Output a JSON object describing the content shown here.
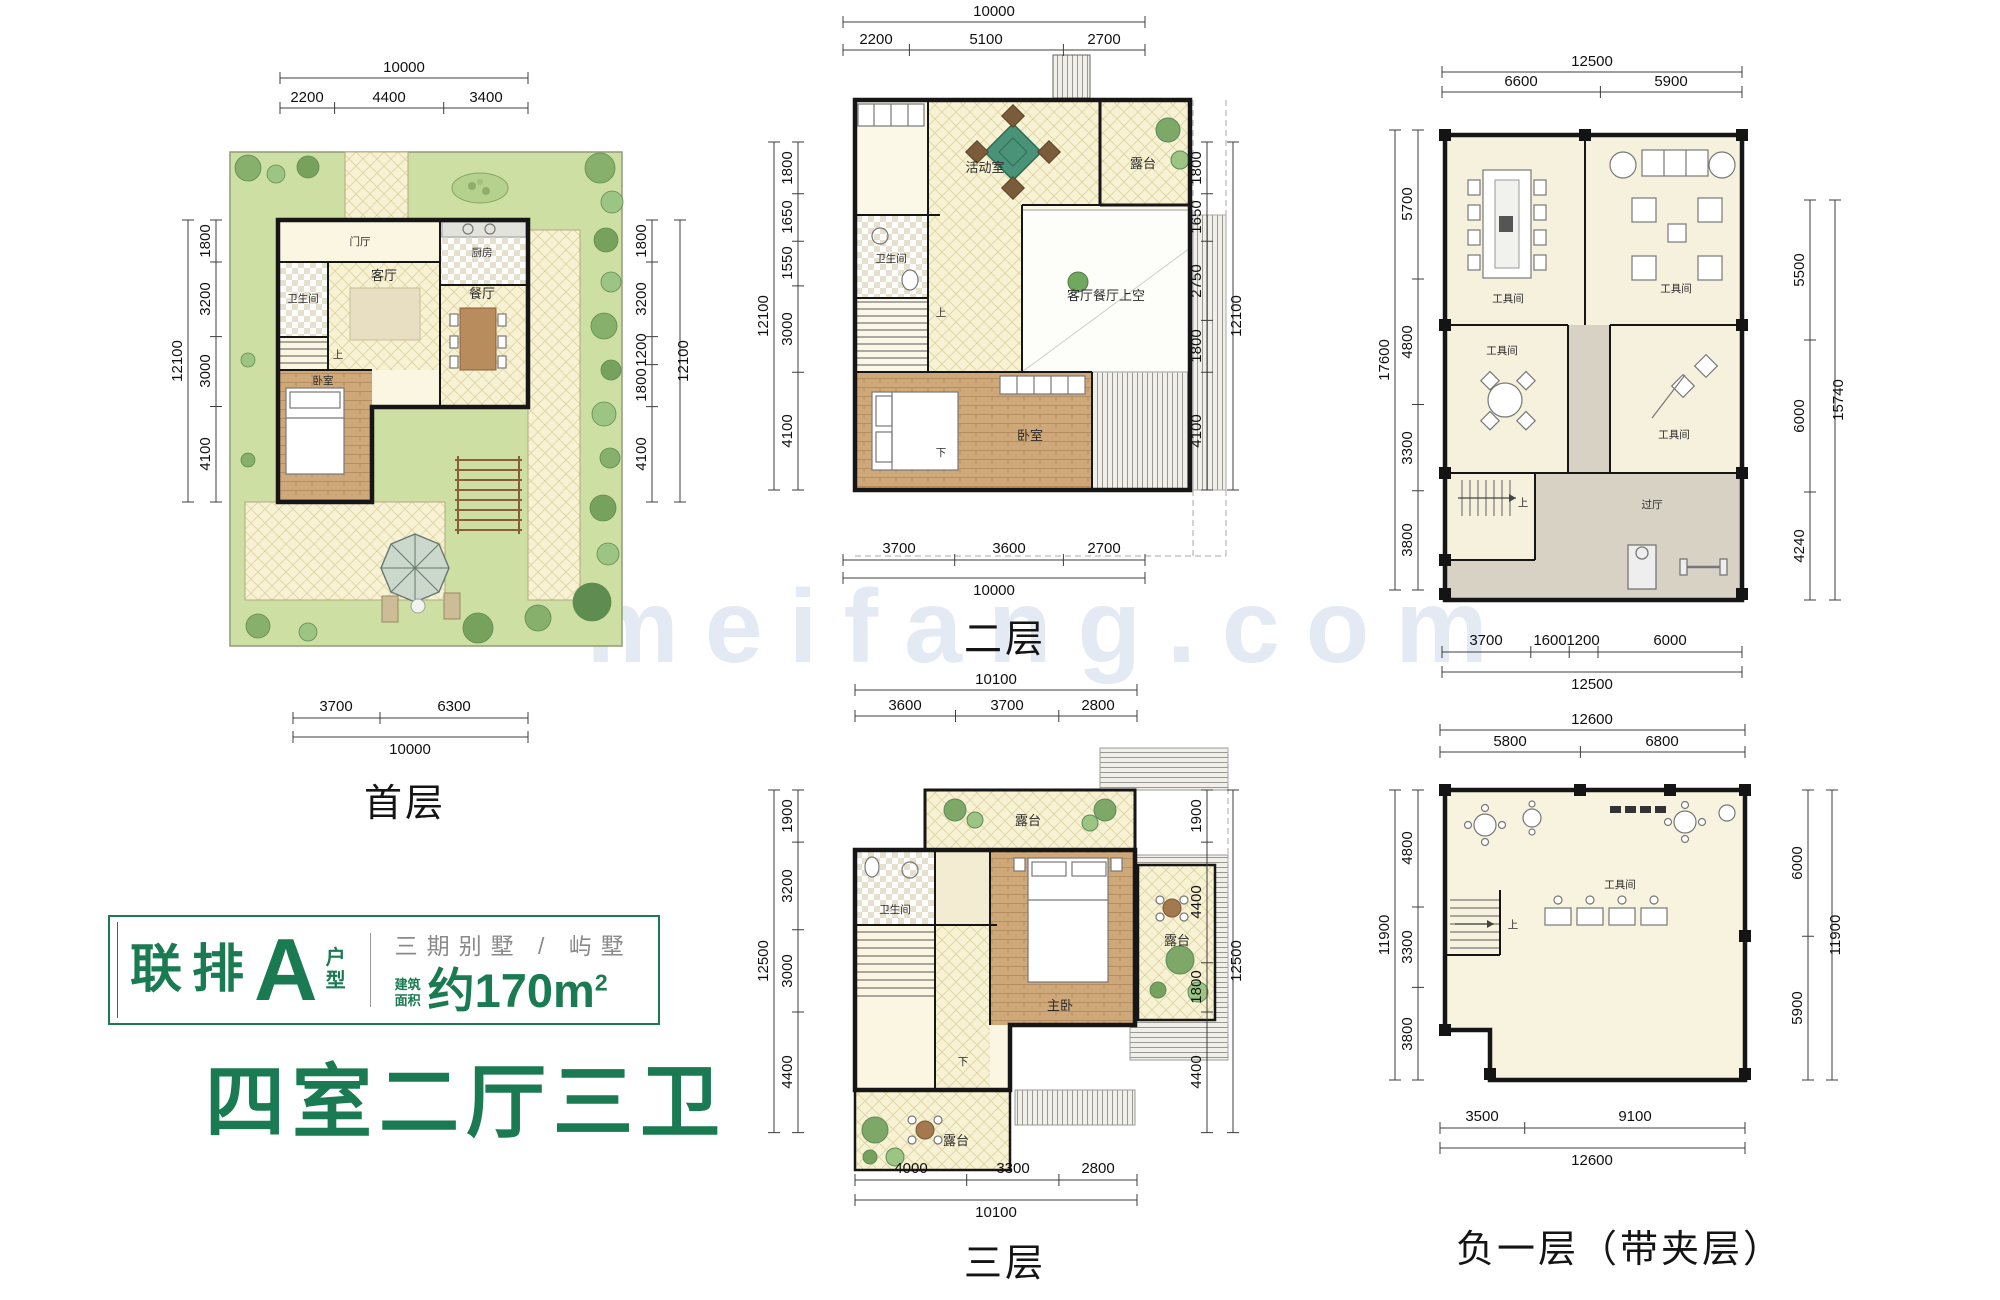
{
  "accent": "#1a7a52",
  "watermark": "meifang.com",
  "info": {
    "series": "联排",
    "letter": "A",
    "type_top": "户",
    "type_bottom": "型",
    "subtitle": "三期别墅 / 屿墅",
    "area_label_top": "建筑",
    "area_label_bottom": "面积",
    "area_value": "约170m",
    "area_sup": "2",
    "rooms_summary": "四室二厅三卫"
  },
  "plans": {
    "p1": {
      "title": "首层",
      "top_total": "10000",
      "top": [
        "2200",
        "4400",
        "3400"
      ],
      "left_total": "12100",
      "left": [
        "1800",
        "3200",
        "3000",
        "4100"
      ],
      "right_total": "12100",
      "right": [
        "1800",
        "3200",
        "1200",
        "1800",
        "4100"
      ],
      "bottom": [
        "3700",
        "6300"
      ],
      "bottom_total": "10000",
      "rooms": {
        "entry": "门厅",
        "bath": "卫生间",
        "living": "客厅",
        "kitchen": "厨房",
        "dining": "餐厅",
        "bed": "卧室",
        "up": "上"
      }
    },
    "p2": {
      "title": "二层",
      "top_total": "10000",
      "top": [
        "2200",
        "5100",
        "2700"
      ],
      "left_total": "12100",
      "left": [
        "1800",
        "1650",
        "1550",
        "3000",
        "4100"
      ],
      "right_total": "12100",
      "right": [
        "1800",
        "1650",
        "2750",
        "1800",
        "4100"
      ],
      "bottom": [
        "3700",
        "3600",
        "2700"
      ],
      "bottom_total": "10000",
      "rooms": {
        "activity": "活动室",
        "bath": "卫生间",
        "terrace": "露台",
        "void": "客厅餐厅上空",
        "bed": "卧室",
        "up": "上",
        "down": "下"
      }
    },
    "p3": {
      "title": "三层",
      "top_total": "10100",
      "top": [
        "3600",
        "3700",
        "2800"
      ],
      "left_total": "12500",
      "left": [
        "1900",
        "3200",
        "3000",
        "4400"
      ],
      "right_total": "12500",
      "right": [
        "1900",
        "4400",
        "1800",
        "4400"
      ],
      "bottom": [
        "4000",
        "3300",
        "2800"
      ],
      "bottom_total": "10100",
      "rooms": {
        "terrace_top": "露台",
        "bath": "卫生间",
        "master": "主卧",
        "terrace_right": "露台",
        "terrace_bottom": "露台",
        "down": "下"
      }
    },
    "b1": {
      "top_total": "12500",
      "top": [
        "6600",
        "5900"
      ],
      "left_total": "17600",
      "left": [
        "5700",
        "4800",
        "3300",
        "3800"
      ],
      "right_total": "15740",
      "right": [
        "5500",
        "6000",
        "4240"
      ],
      "bottom": [
        "3700",
        "1600",
        "1200",
        "6000"
      ],
      "bottom_total": "12500",
      "rooms": {
        "tool1": "工具间",
        "tool2": "工具间",
        "tool3": "工具间",
        "tool4": "工具间",
        "hall": "过厅",
        "up": "上"
      }
    },
    "b2": {
      "title": "负一层（带夹层）",
      "top_total": "12600",
      "top": [
        "5800",
        "6800"
      ],
      "left_total": "11900",
      "left": [
        "4800",
        "3300",
        "3800"
      ],
      "right_total": "11900",
      "right": [
        "6000",
        "5900"
      ],
      "bottom": [
        "3500",
        "9100"
      ],
      "bottom_total": "12600",
      "rooms": {
        "tool": "工具间",
        "up": "上"
      }
    }
  }
}
